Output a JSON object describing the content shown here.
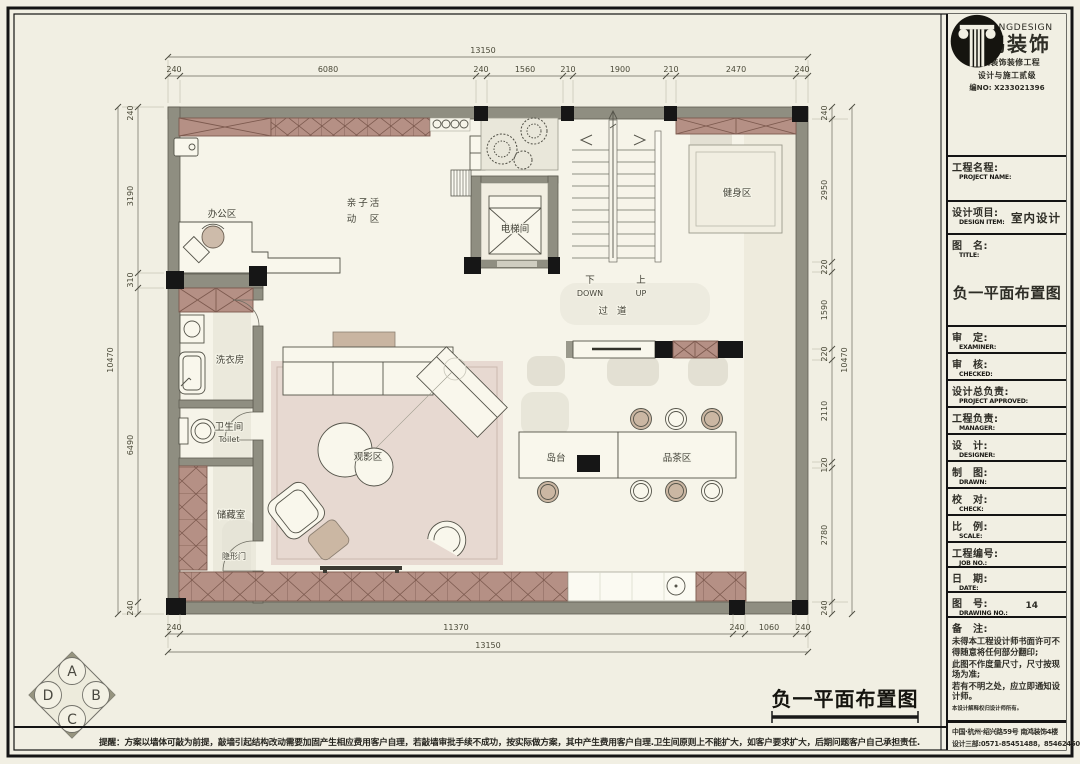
{
  "plan": {
    "dims": {
      "top_total": "13150",
      "top_segments": [
        "240",
        "6080",
        "240",
        "1560",
        "210",
        "1900",
        "210",
        "2470",
        "240"
      ],
      "bottom_total": "13150",
      "bottom_segments": [
        "240",
        "11370",
        "240",
        "1060",
        "240"
      ],
      "left_total": "10470",
      "left_segments": [
        "240",
        "3190",
        "310",
        "6490",
        "240"
      ],
      "right_total": "10470",
      "right_segments": [
        "240",
        "2950",
        "220",
        "1590",
        "220",
        "2110",
        "120",
        "2780",
        "240"
      ]
    },
    "rooms": {
      "office": "办公区",
      "activity_line1": "亲子活",
      "activity_line2": "动　区",
      "elevator": "电梯间",
      "gym": "健身区",
      "corridor": "过 道",
      "laundry": "洗衣房",
      "toilet_zh": "卫生间",
      "toilet_en": "Toilet",
      "storage": "储藏室",
      "hidden_door": "隐形门",
      "cinema": "观影区",
      "island": "岛台",
      "tea": "品茶区"
    },
    "stairs": {
      "down_zh": "下",
      "down_en": "DOWN",
      "up_zh": "上",
      "up_en": "UP"
    }
  },
  "compass": {
    "top": "A",
    "right": "B",
    "bottom": "C",
    "left": "D"
  },
  "footer": {
    "drawing_title": "负一平面布置图",
    "reminder": "提醒：方案以墙体可敲为前提，敲墙引起结构改动需要加固产生相应费用客户自理，若敲墙审批手续不成功，按实际做方案，其中产生费用客户自理.卫生间原则上不能扩大，如客户要求扩大，后期问题客户自己承担责任."
  },
  "title_block": {
    "brand_en": "NANHONGDESIGN",
    "brand_zh": "南鸿装饰",
    "cert_line1": "建筑装饰装修工程",
    "cert_line2": "设计与施工贰级",
    "cert_no": "编NO: X233021396",
    "drawing_title": "负一平面布置图",
    "fields": [
      {
        "zh": "工程名程:",
        "en": "PROJECT NAME:",
        "value": ""
      },
      {
        "zh": "设计项目:",
        "en": "DESIGN ITEM:",
        "value": "室内设计"
      },
      {
        "zh": "图　名:",
        "en": "TITLE:",
        "value": ""
      },
      {
        "zh": "审　定:",
        "en": "EXAMINER:",
        "value": ""
      },
      {
        "zh": "审　核:",
        "en": "CHECKED:",
        "value": ""
      },
      {
        "zh": "设计总负责:",
        "en": "PROJECT APPROVED:",
        "value": ""
      },
      {
        "zh": "工程负责:",
        "en": "MANAGER:",
        "value": ""
      },
      {
        "zh": "设　计:",
        "en": "DESIGNER:",
        "value": ""
      },
      {
        "zh": "制　图:",
        "en": "DRAWN:",
        "value": ""
      },
      {
        "zh": "校　对:",
        "en": "CHECK:",
        "value": ""
      },
      {
        "zh": "比　例:",
        "en": "SCALE:",
        "value": ""
      },
      {
        "zh": "工程编号:",
        "en": "JOB NO.:",
        "value": ""
      },
      {
        "zh": "日　期:",
        "en": "DATE:",
        "value": ""
      },
      {
        "zh": "图　号:",
        "en": "DRAWING NO.:",
        "value": "14"
      }
    ],
    "notes_zh": "备　注:",
    "note1": "未得本工程设计师书面许可不得随意将任何部分翻印;",
    "note2": "此图不作度量尺寸，尺寸按现场为准;",
    "note3": "若有不明之处，应立即通知设计师。",
    "notes_small": "本设计解释权归设计师所有。",
    "address": "中国·杭州·绍兴路59号 南鸿装饰4楼",
    "phone": "设计三部:0571-85451488，85462450"
  }
}
